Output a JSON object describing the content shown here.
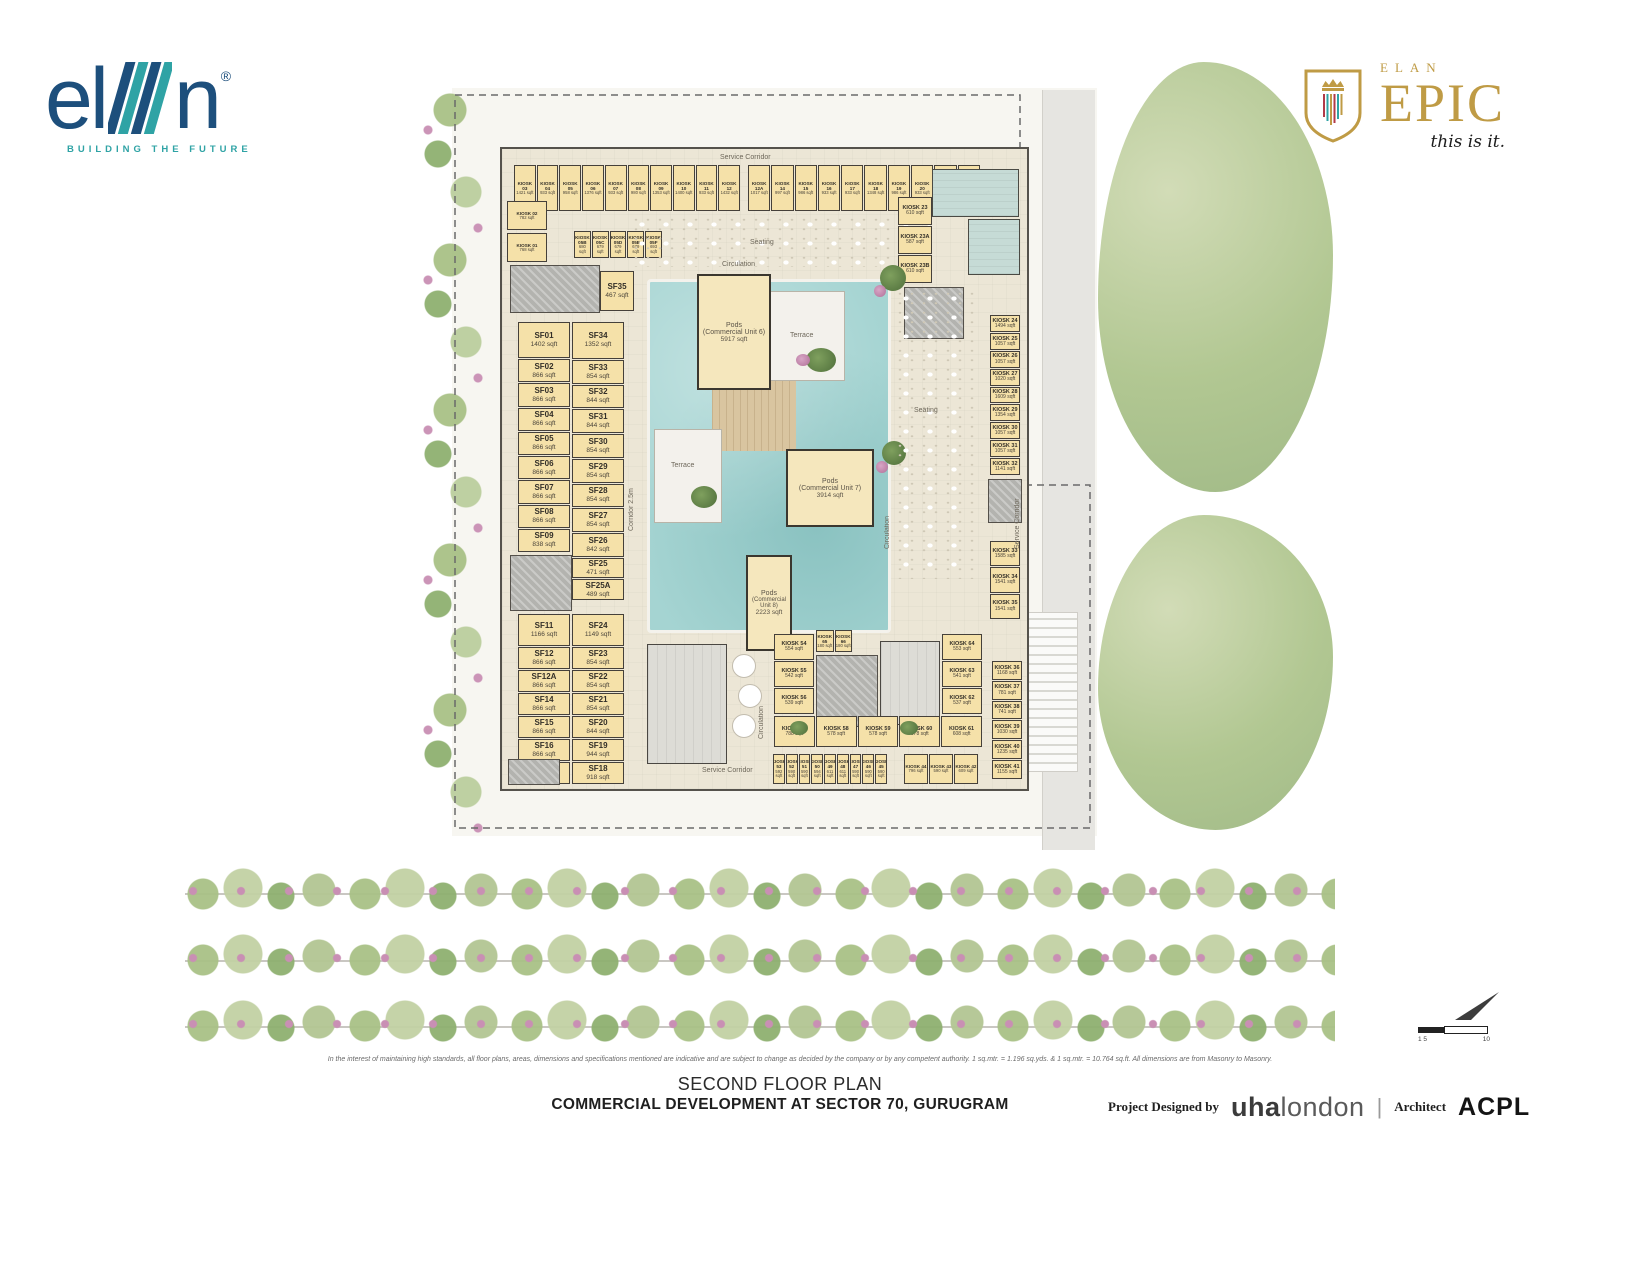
{
  "branding": {
    "elan": {
      "word_el": "el",
      "word_n": "n",
      "registered": "®",
      "tagline": "BUILDING THE FUTURE"
    },
    "epic": {
      "brand": "ELAN",
      "name": "EPIC",
      "tagline": "this is it."
    }
  },
  "plan": {
    "labels": {
      "service_corridor_top": "Service Corridor",
      "service_corridor_bottom": "Service Corridor",
      "service_corridor_right": "Service Corridor",
      "circulation_top": "Circulation",
      "circulation_left": "Circulation",
      "circulation_right": "Circulation",
      "seating_top": "Seating",
      "seating_right": "Seating",
      "terrace_upper": "Terrace",
      "terrace_lower": "Terrace",
      "corridor_left": "Corridor 2.5m"
    },
    "pods": [
      {
        "n": "Pods",
        "u": "(Commercial Unit 6)",
        "a": "5917 sqft"
      },
      {
        "n": "Pods",
        "u": "(Commercial Unit 7)",
        "a": "3914 sqft"
      },
      {
        "n": "Pods",
        "u": "(Commercial Unit 8)",
        "a": "2223 sqft"
      }
    ],
    "top_row_a": [
      {
        "name": "KIOSK 03",
        "area": "1421 sqft"
      },
      {
        "name": "KIOSK 04",
        "area": "933 sqft"
      },
      {
        "name": "KIOSK 05",
        "area": "958 sqft"
      },
      {
        "name": "KIOSK 06",
        "area": "1376 sqft"
      },
      {
        "name": "KIOSK 07",
        "area": "933 sqft"
      },
      {
        "name": "KIOSK 08",
        "area": "980 sqft"
      },
      {
        "name": "KIOSK 09",
        "area": "1353 sqft"
      },
      {
        "name": "KIOSK 10",
        "area": "1400 sqft"
      },
      {
        "name": "KIOSK 11",
        "area": "933 sqft"
      },
      {
        "name": "KIOSK 12",
        "area": "1432 sqft"
      }
    ],
    "top_row_b": [
      {
        "name": "KIOSK 12A",
        "area": "1017 sqft"
      },
      {
        "name": "KIOSK 14",
        "area": "997 sqft"
      },
      {
        "name": "KIOSK 15",
        "area": "986 sqft"
      },
      {
        "name": "KIOSK 16",
        "area": "933 sqft"
      },
      {
        "name": "KIOSK 17",
        "area": "933 sqft"
      },
      {
        "name": "KIOSK 18",
        "area": "1348 sqft"
      },
      {
        "name": "KIOSK 19",
        "area": "986 sqft"
      },
      {
        "name": "KIOSK 20",
        "area": "933 sqft"
      },
      {
        "name": "KIOSK 21",
        "area": "933 sqft"
      },
      {
        "name": "KIOSK 22",
        "area": "948 sqft"
      }
    ],
    "kiosk02": {
      "name": "KIOSK 02",
      "area": "782 sqft"
    },
    "kiosk01": {
      "name": "KIOSK 01",
      "area": "768 sqft"
    },
    "small_row": [
      {
        "name": "KIOSK 05B",
        "area": "680 sqft"
      },
      {
        "name": "KIOSK 05C",
        "area": "679 sqft"
      },
      {
        "name": "KIOSK 05D",
        "area": "679 sqft"
      },
      {
        "name": "KIOSK 05E",
        "area": "679 sqft"
      },
      {
        "name": "KIOSK 05F",
        "area": "693 sqft"
      }
    ],
    "kiosk23_col": [
      {
        "name": "KIOSK 23",
        "area": "610 sqft"
      },
      {
        "name": "KIOSK 23A",
        "area": "587 sqft"
      },
      {
        "name": "KIOSK 23B",
        "area": "610 sqft"
      }
    ],
    "sf35": {
      "name": "SF35",
      "area": "467 sqft"
    },
    "sf_col1": [
      {
        "name": "SF01",
        "area": "1402 sqft"
      },
      {
        "name": "SF02",
        "area": "866 sqft"
      },
      {
        "name": "SF03",
        "area": "866 sqft"
      },
      {
        "name": "SF04",
        "area": "866 sqft"
      },
      {
        "name": "SF05",
        "area": "866 sqft"
      },
      {
        "name": "SF06",
        "area": "866 sqft"
      },
      {
        "name": "SF07",
        "area": "866 sqft"
      },
      {
        "name": "SF08",
        "area": "866 sqft"
      },
      {
        "name": "SF09",
        "area": "838 sqft"
      }
    ],
    "sf_col2": [
      {
        "name": "SF34",
        "area": "1352 sqft"
      },
      {
        "name": "SF33",
        "area": "854 sqft"
      },
      {
        "name": "SF32",
        "area": "844 sqft"
      },
      {
        "name": "SF31",
        "area": "844 sqft"
      },
      {
        "name": "SF30",
        "area": "854 sqft"
      },
      {
        "name": "SF29",
        "area": "854 sqft"
      },
      {
        "name": "SF28",
        "area": "854 sqft"
      },
      {
        "name": "SF27",
        "area": "854 sqft"
      },
      {
        "name": "SF26",
        "area": "842 sqft"
      },
      {
        "name": "SF25",
        "area": "471 sqft"
      },
      {
        "name": "SF25A",
        "area": "489 sqft"
      }
    ],
    "sf_col3": [
      {
        "name": "SF11",
        "area": "1166 sqft"
      },
      {
        "name": "SF12",
        "area": "866 sqft"
      },
      {
        "name": "SF12A",
        "area": "866 sqft"
      },
      {
        "name": "SF14",
        "area": "866 sqft"
      },
      {
        "name": "SF15",
        "area": "866 sqft"
      },
      {
        "name": "SF16",
        "area": "866 sqft"
      },
      {
        "name": "SF17",
        "area": "901 sqft"
      }
    ],
    "sf_col4": [
      {
        "name": "SF24",
        "area": "1149 sqft"
      },
      {
        "name": "SF23",
        "area": "854 sqft"
      },
      {
        "name": "SF22",
        "area": "854 sqft"
      },
      {
        "name": "SF21",
        "area": "854 sqft"
      },
      {
        "name": "SF20",
        "area": "844 sqft"
      },
      {
        "name": "SF19",
        "area": "944 sqft"
      },
      {
        "name": "SF18",
        "area": "918 sqft"
      }
    ],
    "right_col_upper": [
      {
        "name": "KIOSK 24",
        "area": "1494 sqft"
      },
      {
        "name": "KIOSK 25",
        "area": "1057 sqft"
      },
      {
        "name": "KIOSK 26",
        "area": "1057 sqft"
      },
      {
        "name": "KIOSK 27",
        "area": "1020 sqft"
      },
      {
        "name": "KIOSK 28",
        "area": "1609 sqft"
      },
      {
        "name": "KIOSK 29",
        "area": "1354 sqft"
      },
      {
        "name": "KIOSK 30",
        "area": "1057 sqft"
      },
      {
        "name": "KIOSK 31",
        "area": "1057 sqft"
      },
      {
        "name": "KIOSK 32",
        "area": "1141 sqft"
      }
    ],
    "right_col_mid": [
      {
        "name": "KIOSK 33",
        "area": "1585 sqft"
      },
      {
        "name": "KIOSK 34",
        "area": "1541 sqft"
      },
      {
        "name": "KIOSK 35",
        "area": "1541 sqft"
      }
    ],
    "right_col_lower": [
      {
        "name": "KIOSK 36",
        "area": "1168 sqft"
      },
      {
        "name": "KIOSK 37",
        "area": "781 sqft"
      },
      {
        "name": "KIOSK 38",
        "area": "741 sqft"
      },
      {
        "name": "KIOSK 39",
        "area": "1030 sqft"
      },
      {
        "name": "KIOSK 40",
        "area": "1235 sqft"
      },
      {
        "name": "KIOSK 41",
        "area": "1155 sqft"
      }
    ],
    "bc_left": [
      {
        "name": "KIOSK 54",
        "area": "554 sqft"
      },
      {
        "name": "KIOSK 55",
        "area": "542 sqft"
      },
      {
        "name": "KIOSK 56",
        "area": "539 sqft"
      }
    ],
    "bc_top": [
      {
        "name": "KIOSK 65",
        "area": "180 sqft"
      },
      {
        "name": "KIOSK 66",
        "area": "180 sqft"
      }
    ],
    "bc_right": [
      {
        "name": "KIOSK 64",
        "area": "553 sqft"
      },
      {
        "name": "KIOSK 63",
        "area": "541 sqft"
      },
      {
        "name": "KIOSK 62",
        "area": "537 sqft"
      }
    ],
    "bc_bottom": [
      {
        "name": "KIOSK 57",
        "area": "788 sqft"
      },
      {
        "name": "KIOSK 58",
        "area": "578 sqft"
      },
      {
        "name": "KIOSK 59",
        "area": "578 sqft"
      },
      {
        "name": "KIOSK 60",
        "area": "578 sqft"
      },
      {
        "name": "KIOSK 61",
        "area": "608 sqft"
      }
    ],
    "bottom_row_left": [
      {
        "name": "KIOSK 53",
        "area": "592 sqft"
      },
      {
        "name": "KIOSK 52",
        "area": "590 sqft"
      },
      {
        "name": "KIOSK 51",
        "area": "590 sqft"
      },
      {
        "name": "KIOSK 50",
        "area": "594 sqft"
      },
      {
        "name": "KIOSK 49",
        "area": "611 sqft"
      },
      {
        "name": "KIOSK 48",
        "area": "611 sqft"
      },
      {
        "name": "KIOSK 47",
        "area": "590 sqft"
      },
      {
        "name": "KIOSK 46",
        "area": "590 sqft"
      },
      {
        "name": "KIOSK 45",
        "area": "590 sqft"
      }
    ],
    "bottom_row_right": [
      {
        "name": "KIOSK 44",
        "area": "796 sqft"
      },
      {
        "name": "KIOSK 43",
        "area": "590 sqft"
      },
      {
        "name": "KIOSK 42",
        "area": "609 sqft"
      }
    ]
  },
  "scale": {
    "left_labels": "1 5",
    "right_label": "10"
  },
  "footer": {
    "disclaimer": "In the interest of maintaining high standards, all floor plans, areas, dimensions and specifications mentioned are indicative and are subject to change as decided by the company or by any competent authority. 1 sq.mtr. = 1.196 sq.yds. & 1 sq.mtr. = 10.764 sq.ft. All dimensions are from Masonry to Masonry.",
    "plan_title": "SECOND FLOOR PLAN",
    "project_title": "COMMERCIAL DEVELOPMENT AT SECTOR 70, GURUGRAM",
    "designed_by_label": "Project Designed by",
    "designer_bold": "uha",
    "designer_light": "london",
    "divider": "|",
    "architect_label": "Architect",
    "architect_name": "ACPL"
  }
}
